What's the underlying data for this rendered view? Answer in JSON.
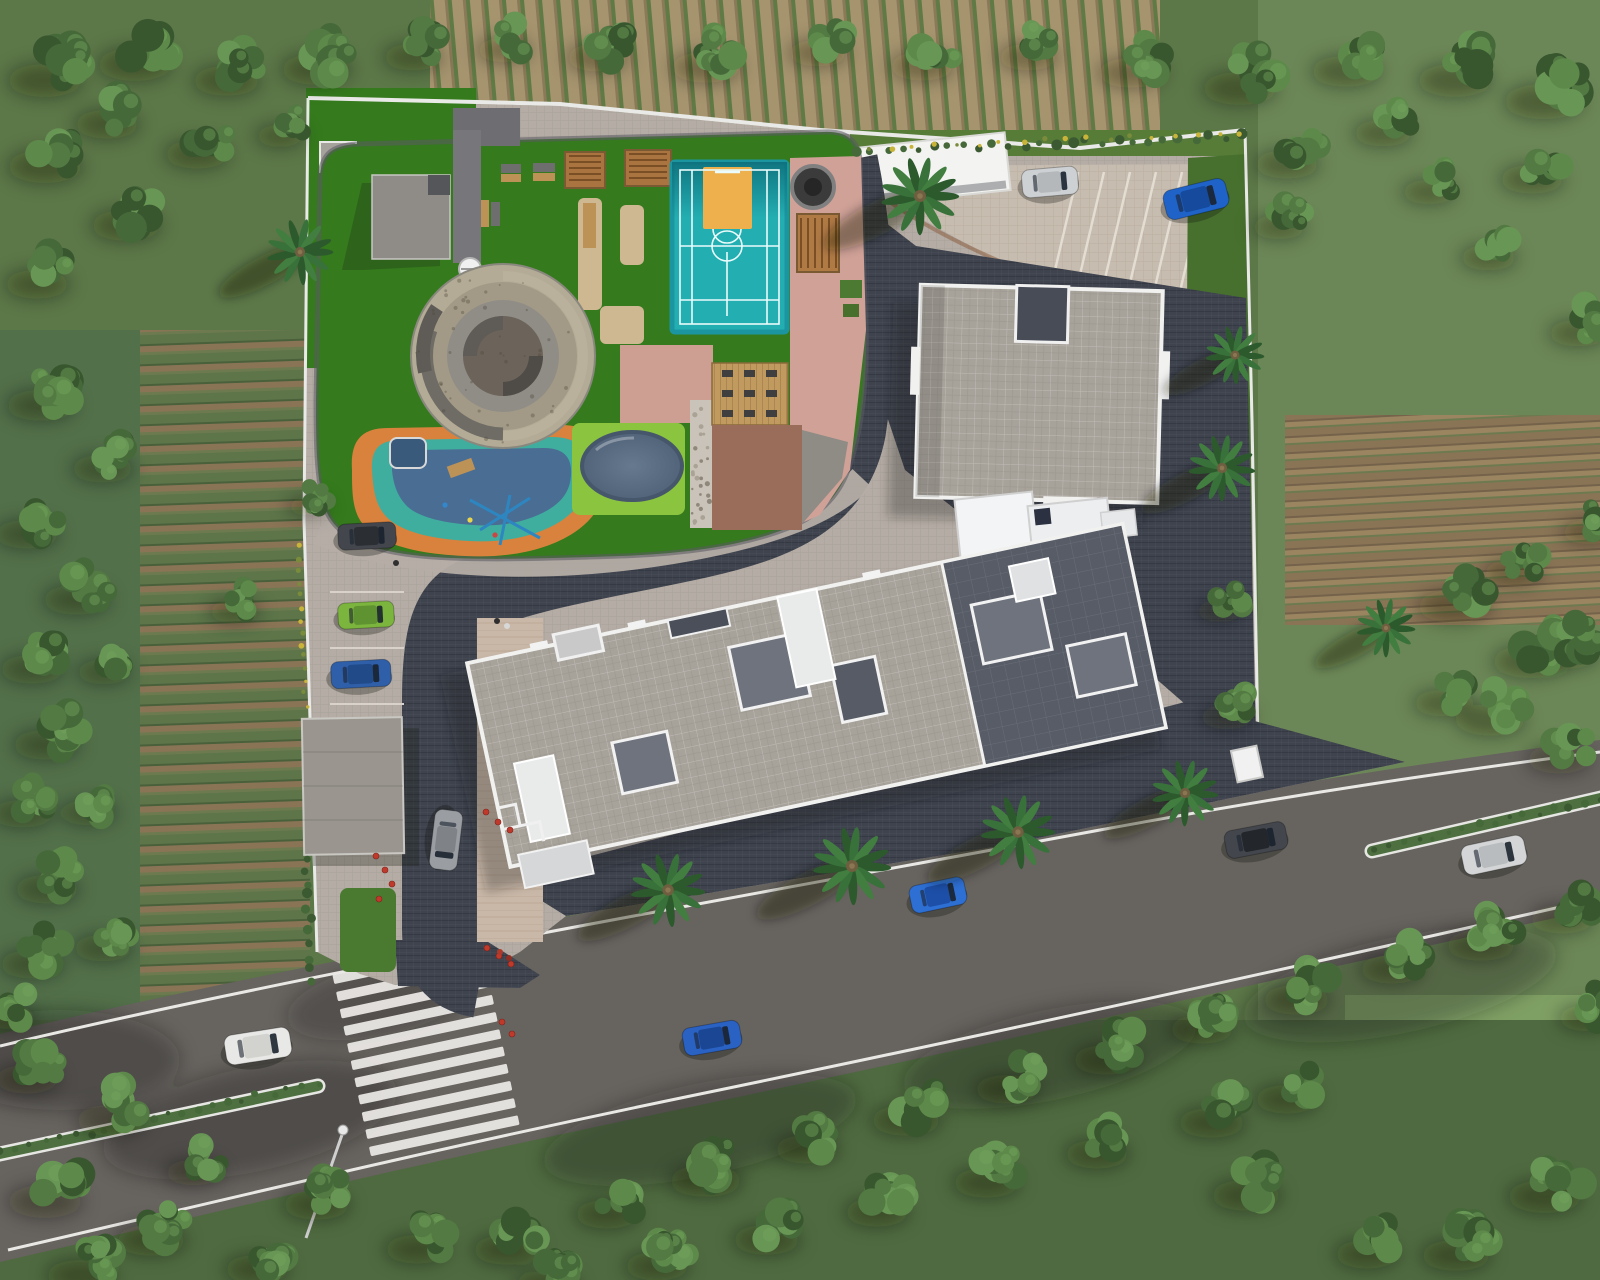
{
  "meta": {
    "title": "Residential complex – aerial site plan 3D rendering",
    "type": "architectural-rendering",
    "view": "top-down aerial"
  },
  "palette": {
    "base": "#5c7748",
    "fieldGreen": "#5d7549",
    "fieldBrown": "#8a7456",
    "fieldDark": "#49603b",
    "fieldTan": "#a5946e",
    "rightField": "#6c8757",
    "rightFieldLight": "#7fa065",
    "asphalt": "#67635f",
    "roadLine": "#e9e8e4",
    "hedge": "#4e7040",
    "hedgeDark": "#3c5a32",
    "pavLight": "#b5ada5",
    "pavWarm": "#c7bcb0",
    "pavDark": "#3e434e",
    "beige": "#c9b8a8",
    "roofLight": "#a7a29a",
    "roofDark": "#575c67",
    "parapet": "#f1f1f0",
    "towerWhite": "#f3f4f5",
    "apron": "#474c57",
    "lawn": "#357a1d",
    "lawn2": "#47702e",
    "lime": "#8bc43f",
    "court": "#23aeb2",
    "courtShade": "#0d6f7a",
    "courtLine": "#eafcfb",
    "key": "#edb04d",
    "salmon": "#cfa197",
    "salmon2": "#cd9e92",
    "brownPav": "#9a6d5b",
    "wood": "#bd9257",
    "deckWood": "#c09a5f",
    "stone": "#b3ab95",
    "stone2": "#a29a86",
    "spiralGray": "#8f8d86",
    "spiralDark": "#6c635a",
    "spiralArm": "#5f5c57",
    "playOrange": "#d8823d",
    "playTeal": "#3fae9f",
    "playBlue": "#4a6d94",
    "pool": "#5d7085",
    "poolRim": "#46566b",
    "pebble": "#c9c3b9",
    "white": "#f2f2f2",
    "red": "#c03a2c",
    "yellow": "#c9b43a",
    "canopyGray": "#9a968f",
    "clubGray": "#8f8c88",
    "darkStruct": "#6e6e72",
    "wall": "#e9e9e7"
  },
  "environment": {
    "surroundings": [
      "dense tree belt",
      "plowed farmland rows",
      "green crop fields"
    ],
    "tree_greens": [
      "#39572f",
      "#46693a",
      "#527a42",
      "#5d8a4a",
      "#689655"
    ]
  },
  "road": {
    "name": "main road",
    "crosswalk_stripes": 11,
    "median_hedge_segments": 2,
    "edge_lines": true,
    "street_lamp": true
  },
  "site": {
    "boundary": "white compound wall",
    "internal_loop_road": true,
    "parking_slots_topright": 7,
    "entry_booth": true,
    "amenities": [
      "multi-sport court",
      "basketball half-court",
      "pergola seating",
      "fire-pit lounge",
      "spiral mound garden",
      "kids playground",
      "oval splash pool",
      "outdoor gym deck",
      "pebble walk",
      "lawn"
    ]
  },
  "buildings": [
    {
      "name": "tower-a",
      "roof": "square paver deck, white parapet, open light-well"
    },
    {
      "name": "tower-b",
      "roof": "long slab, light and dark paver decks, white parapet, terraces"
    }
  ],
  "vehicles": [
    {
      "name": "white-van-road",
      "color": "#e8e8e6",
      "roof": "#d2d2cf",
      "x": 258,
      "y": 1046,
      "len": 66,
      "wid": 30,
      "angle": -9
    },
    {
      "name": "blue-hatchback-road",
      "color": "#2a62c4",
      "roof": "#1b4693",
      "x": 712,
      "y": 1038,
      "len": 58,
      "wid": 28,
      "angle": -10
    },
    {
      "name": "dark-sedan-road",
      "color": "#43474d",
      "roof": "#23262b",
      "x": 1256,
      "y": 840,
      "len": 62,
      "wid": 28,
      "angle": -11
    },
    {
      "name": "silver-sedan-road",
      "color": "#d3d5d6",
      "roof": "#b9bcbe",
      "x": 1494,
      "y": 855,
      "len": 64,
      "wid": 30,
      "angle": -12
    },
    {
      "name": "blue-car-frontage",
      "color": "#2e6fd3",
      "roof": "#1d4fa8",
      "x": 938,
      "y": 895,
      "len": 56,
      "wid": 28,
      "angle": -12
    },
    {
      "name": "gray-car-driveway",
      "color": "#9a9da1",
      "roof": "#7f8287",
      "x": 446,
      "y": 840,
      "len": 60,
      "wid": 28,
      "angle": 97
    },
    {
      "name": "dark-suv-parking",
      "color": "#43474d",
      "roof": "#2b2e33",
      "x": 367,
      "y": 536,
      "len": 58,
      "wid": 26,
      "angle": -3
    },
    {
      "name": "green-car-parking",
      "color": "#7cb53e",
      "roof": "#5f9230",
      "x": 366,
      "y": 615,
      "len": 56,
      "wid": 26,
      "angle": -3
    },
    {
      "name": "blue-car-parking",
      "color": "#2f5fa8",
      "roof": "#214a88",
      "x": 361,
      "y": 674,
      "len": 60,
      "wid": 27,
      "angle": -3
    },
    {
      "name": "silver-suv-top-parking",
      "color": "#ced1d3",
      "roof": "#b5b8ba",
      "x": 1050,
      "y": 182,
      "len": 56,
      "wid": 28,
      "angle": -5
    },
    {
      "name": "blue-car-top-parking",
      "color": "#1f63c8",
      "roof": "#154a9d",
      "x": 1196,
      "y": 199,
      "len": 64,
      "wid": 30,
      "angle": -14
    }
  ],
  "palms": [
    {
      "x": 300,
      "y": 252,
      "s": 34
    },
    {
      "x": 920,
      "y": 196,
      "s": 40
    },
    {
      "x": 1235,
      "y": 355,
      "s": 30
    },
    {
      "x": 1222,
      "y": 468,
      "s": 34
    },
    {
      "x": 1386,
      "y": 628,
      "s": 30
    },
    {
      "x": 668,
      "y": 890,
      "s": 38
    },
    {
      "x": 852,
      "y": 866,
      "s": 40
    },
    {
      "x": 1018,
      "y": 832,
      "s": 38
    },
    {
      "x": 1185,
      "y": 793,
      "s": 34
    }
  ],
  "trees": {
    "clusters": [
      [
        60,
        64,
        30
      ],
      [
        150,
        48,
        30
      ],
      [
        240,
        66,
        27
      ],
      [
        330,
        54,
        28
      ],
      [
        425,
        44,
        24
      ],
      [
        515,
        38,
        22
      ],
      [
        610,
        44,
        25
      ],
      [
        720,
        52,
        28
      ],
      [
        830,
        40,
        24
      ],
      [
        935,
        52,
        26
      ],
      [
        1040,
        44,
        24
      ],
      [
        1145,
        58,
        27
      ],
      [
        1255,
        72,
        30
      ],
      [
        1360,
        56,
        28
      ],
      [
        1470,
        64,
        30
      ],
      [
        1560,
        84,
        32
      ],
      [
        60,
        150,
        30
      ],
      [
        140,
        210,
        28
      ],
      [
        50,
        270,
        26
      ],
      [
        210,
        140,
        26
      ],
      [
        120,
        110,
        26
      ],
      [
        290,
        125,
        20
      ],
      [
        1300,
        150,
        26
      ],
      [
        1395,
        120,
        24
      ],
      [
        1290,
        215,
        22
      ],
      [
        1545,
        165,
        26
      ],
      [
        1500,
        245,
        23
      ],
      [
        1590,
        320,
        24
      ],
      [
        1440,
        180,
        22
      ],
      [
        55,
        390,
        28
      ],
      [
        115,
        455,
        25
      ],
      [
        40,
        520,
        26
      ],
      [
        90,
        585,
        27
      ],
      [
        45,
        655,
        26
      ],
      [
        115,
        660,
        22
      ],
      [
        60,
        730,
        27
      ],
      [
        35,
        800,
        25
      ],
      [
        100,
        800,
        23
      ],
      [
        60,
        875,
        26
      ],
      [
        115,
        935,
        24
      ],
      [
        45,
        950,
        26
      ],
      [
        20,
        1005,
        22
      ],
      [
        316,
        497,
        17
      ],
      [
        245,
        600,
        21
      ],
      [
        1230,
        600,
        20
      ],
      [
        1238,
        705,
        22
      ],
      [
        1470,
        590,
        30
      ],
      [
        1545,
        645,
        30
      ],
      [
        1505,
        705,
        28
      ],
      [
        1572,
        745,
        26
      ],
      [
        1455,
        690,
        24
      ],
      [
        1525,
        560,
        24
      ],
      [
        1580,
        640,
        26
      ],
      [
        1600,
        520,
        22
      ],
      [
        40,
        1065,
        26
      ],
      [
        125,
        1105,
        28
      ],
      [
        60,
        1185,
        30
      ],
      [
        165,
        1225,
        28
      ],
      [
        270,
        1255,
        26
      ],
      [
        205,
        1160,
        23
      ],
      [
        330,
        1190,
        27
      ],
      [
        430,
        1235,
        26
      ],
      [
        95,
        1260,
        28
      ],
      [
        520,
        1235,
        27
      ],
      [
        620,
        1200,
        26
      ],
      [
        720,
        1165,
        29
      ],
      [
        820,
        1135,
        26
      ],
      [
        920,
        1105,
        28
      ],
      [
        1020,
        1075,
        26
      ],
      [
        1120,
        1045,
        27
      ],
      [
        1215,
        1015,
        26
      ],
      [
        1310,
        985,
        27
      ],
      [
        1405,
        955,
        26
      ],
      [
        1495,
        930,
        28
      ],
      [
        1575,
        905,
        26
      ],
      [
        560,
        1272,
        26
      ],
      [
        670,
        1252,
        26
      ],
      [
        780,
        1225,
        27
      ],
      [
        890,
        1198,
        26
      ],
      [
        1000,
        1168,
        27
      ],
      [
        1110,
        1140,
        26
      ],
      [
        1225,
        1108,
        27
      ],
      [
        1300,
        1085,
        26
      ],
      [
        1560,
        1180,
        30
      ],
      [
        1470,
        1240,
        28
      ],
      [
        1380,
        1240,
        26
      ],
      [
        1600,
        1005,
        24
      ],
      [
        1260,
        1180,
        28
      ]
    ]
  },
  "landscape": {
    "hedges": [
      {
        "x1": 856,
        "y1": 152,
        "x2": 1240,
        "y2": 136,
        "n": 26,
        "r": 4
      },
      {
        "x1": 306,
        "y1": 858,
        "x2": 312,
        "y2": 982,
        "n": 11,
        "r": 4
      },
      {
        "x1": 0,
        "y1": 1152,
        "x2": 318,
        "y2": 1083,
        "n": 22,
        "r": 3
      },
      {
        "x1": 1374,
        "y1": 850,
        "x2": 1600,
        "y2": 798,
        "n": 16,
        "r": 3
      }
    ],
    "flowers": [
      {
        "x1": 298,
        "y1": 545,
        "x2": 306,
        "y2": 706,
        "n": 14
      },
      {
        "x1": 870,
        "y1": 148,
        "x2": 1240,
        "y2": 133,
        "n": 18
      }
    ],
    "red_planters": [
      [
        376,
        856
      ],
      [
        385,
        870
      ],
      [
        392,
        884
      ],
      [
        379,
        899
      ],
      [
        486,
        812
      ],
      [
        498,
        822
      ],
      [
        510,
        830
      ],
      [
        487,
        948
      ],
      [
        499,
        956
      ],
      [
        511,
        964
      ],
      [
        502,
        1022
      ],
      [
        512,
        1034
      ]
    ],
    "people": [
      {
        "x": 497,
        "y": 621,
        "c": "#2e2e2e"
      },
      {
        "x": 507,
        "y": 626,
        "c": "#d8d8d8"
      },
      {
        "x": 500,
        "y": 952,
        "c": "#b03a2a"
      },
      {
        "x": 509,
        "y": 958,
        "c": "#902f22"
      },
      {
        "x": 396,
        "y": 563,
        "c": "#303030"
      }
    ]
  }
}
